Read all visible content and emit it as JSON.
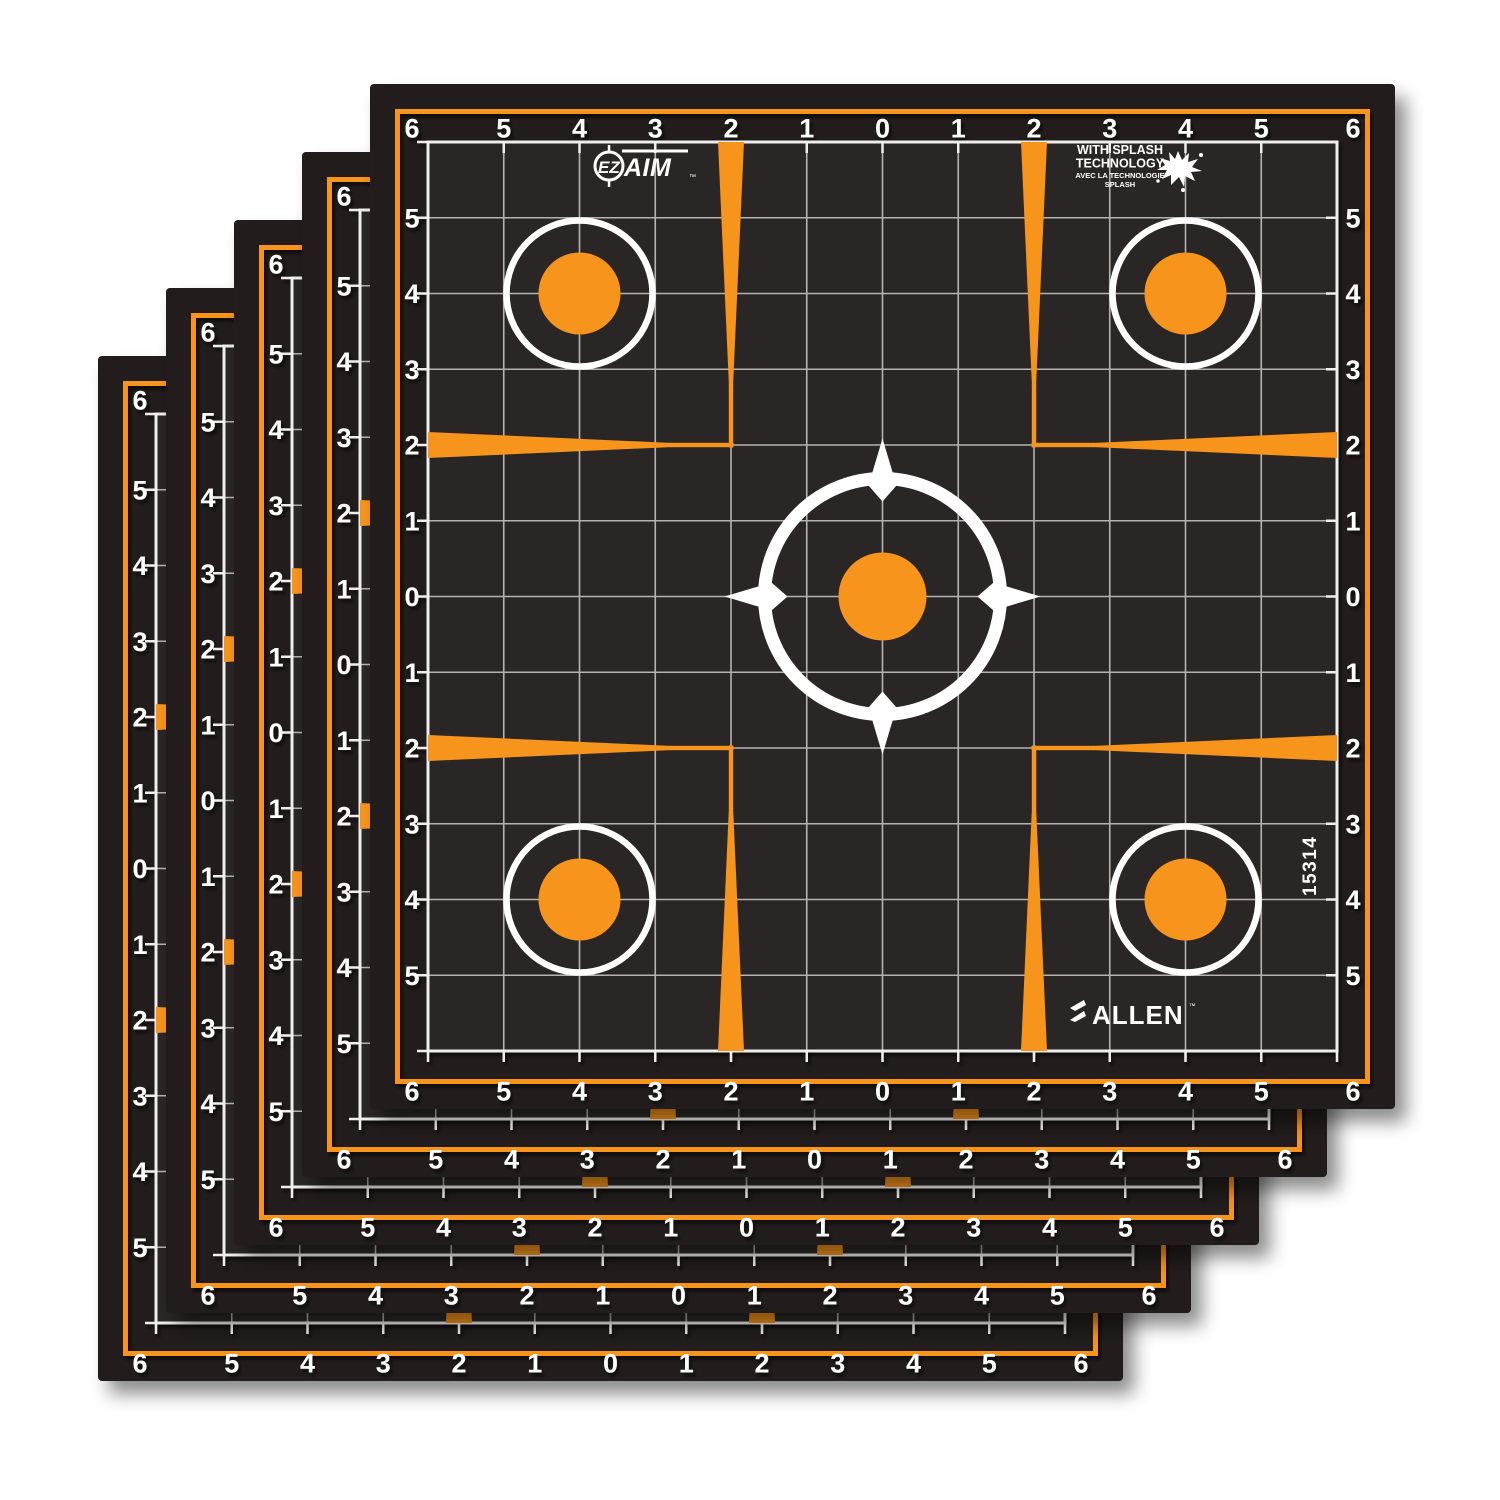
{
  "image": {
    "description": "Stack of five EZ AIM Splash adhesive sight-in grid shooting targets on a white background",
    "background_color": "#FFFFFF"
  },
  "brand": {
    "ez": "EZ",
    "aim": "AIM",
    "logo_tm": "™",
    "allen_name": "ALLEN",
    "allen_tm": "™"
  },
  "tagline": {
    "line1": "WITH SPLASH",
    "line2": "TECHNOLOGY",
    "line3": "AVEC LA TECHNOLOGIE",
    "line4": "SPLASH"
  },
  "sku": "15314",
  "target": {
    "ruler_numbers": [
      "6",
      "5",
      "4",
      "3",
      "2",
      "1",
      "0",
      "1",
      "2",
      "3",
      "4",
      "5",
      "6"
    ],
    "grid_cells_per_side": 12,
    "sheet_count": 5,
    "stack_offset_px": 68,
    "colors": {
      "orange": "#F7941E",
      "sheet_black": "#221E1F",
      "grid_fill": "#2A2627",
      "grid_line": "#B5B2B0",
      "grid_boundary": "#F0EEEC",
      "number_white": "#FFFFFF"
    }
  }
}
